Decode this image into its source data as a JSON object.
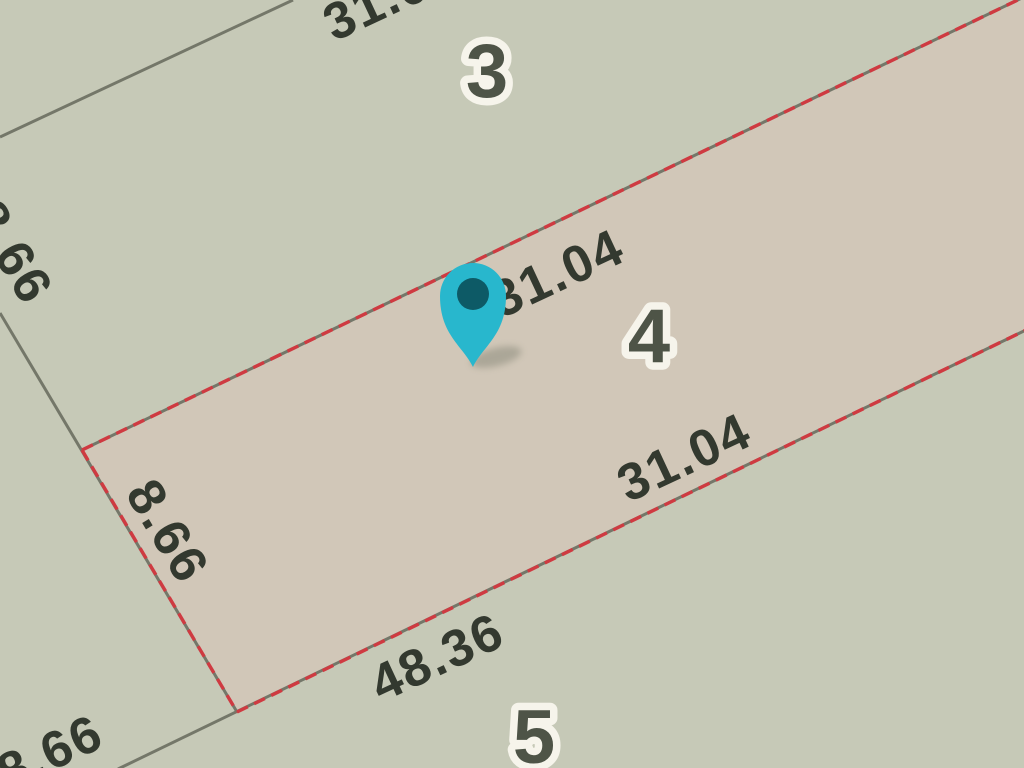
{
  "colors": {
    "background": "#c6c9b7",
    "parcel_highlight_fill": "#d1c7b8",
    "boundary_line_gray": "#747769",
    "boundary_line_red": "#cf3a41",
    "dimension_text": "#33392f",
    "parcel_number_text": "#4e5447",
    "parcel_number_halo": "#f6f4eb",
    "pin_fill": "#28b7cd",
    "pin_center": "#0d5a66"
  },
  "parcel_numbers": [
    {
      "label": "3"
    },
    {
      "label": "4"
    },
    {
      "label": "5"
    }
  ],
  "dimension_labels": {
    "top_boundary_partial": "31.04",
    "parcel4_top_edge": "31.04",
    "parcel4_bottom_edge": "31.04",
    "parcel5_top_edge": "48.36",
    "parcel4_left_edge": "8.66",
    "left_boundary_partial": "8.66",
    "bottom_boundary_partial": "8.66"
  },
  "marker": {
    "icon": "location-pin-icon"
  }
}
